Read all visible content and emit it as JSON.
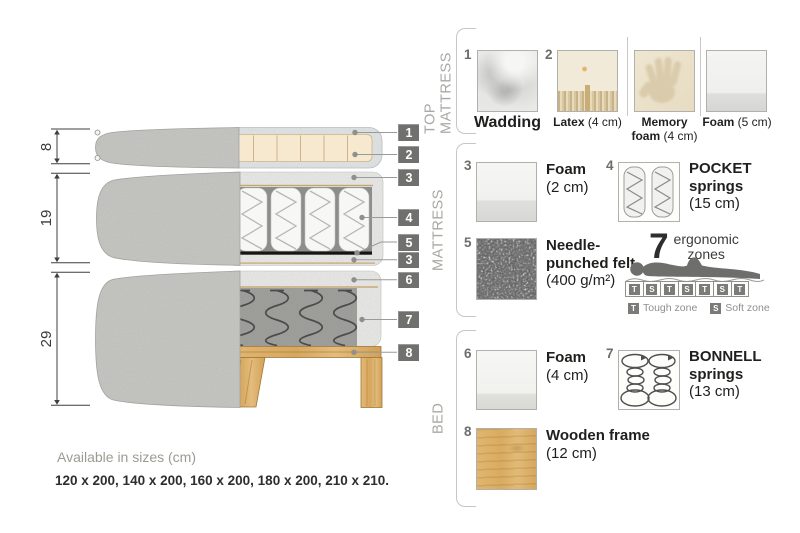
{
  "diagram": {
    "dimensions": [
      {
        "value": "8"
      },
      {
        "value": "19"
      },
      {
        "value": "29"
      }
    ],
    "callouts": [
      {
        "n": "1"
      },
      {
        "n": "2"
      },
      {
        "n": "3"
      },
      {
        "n": "4"
      },
      {
        "n": "5"
      },
      {
        "n": "3"
      },
      {
        "n": "6"
      },
      {
        "n": "7"
      },
      {
        "n": "8"
      }
    ]
  },
  "legend": {
    "top_mattress": {
      "title": "TOP MATTRESS",
      "items": [
        {
          "num": "1",
          "name": "Wadding",
          "size": ""
        },
        {
          "num": "2",
          "name": "Latex",
          "size": "(4 cm)"
        },
        {
          "num": "",
          "name": "Memory foam",
          "size": "(4 cm)"
        },
        {
          "num": "",
          "name": "Foam",
          "size": "(5 cm)"
        }
      ]
    },
    "mattress": {
      "title": "MATTRESS",
      "items": [
        {
          "num": "3",
          "name": "Foam",
          "size": "(2 cm)"
        },
        {
          "num": "4",
          "name": "POCKET springs",
          "size": "(15 cm)"
        },
        {
          "num": "5",
          "name": "Needle-punched felt",
          "size": "(400 g/m²)"
        }
      ],
      "zones": {
        "count": "7",
        "label_line1": "ergonomic",
        "label_line2": "zones",
        "pattern": [
          "T",
          "S",
          "T",
          "S",
          "T",
          "S",
          "T"
        ],
        "keys": [
          {
            "letter": "T",
            "label": "Tough zone"
          },
          {
            "letter": "S",
            "label": "Soft zone"
          }
        ]
      }
    },
    "bed": {
      "title": "BED",
      "items": [
        {
          "num": "6",
          "name": "Foam",
          "size": "(4 cm)"
        },
        {
          "num": "7",
          "name": "BONNELL springs",
          "size": "(13 cm)"
        },
        {
          "num": "8",
          "name": "Wooden frame",
          "size": "(12 cm)"
        }
      ]
    }
  },
  "footer": {
    "heading": "Available in sizes (cm)",
    "sizes": "120 x 200, 140 x 200, 160 x 200, 180 x 200, 210 x 210."
  },
  "colors": {
    "fabric": "#c8c8c4",
    "latex": "#f6e9d0",
    "wood": "#ddb26c",
    "callout_bg": "#70706e"
  }
}
